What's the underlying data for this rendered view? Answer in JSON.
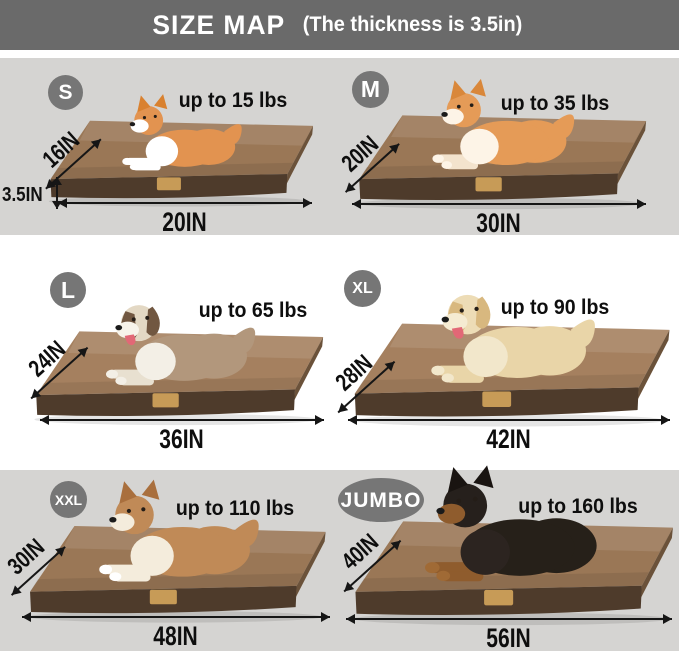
{
  "title": {
    "main": "SIZE MAP",
    "sub": "(The thickness is 3.5in)"
  },
  "panels": [
    {
      "size": "S",
      "weight_limit": "up to 15 lbs",
      "bed_depth": "16IN",
      "bed_width": "20IN",
      "bed_thickness": "3.5IN",
      "dog_breed": "corgi-puppy"
    },
    {
      "size": "M",
      "weight_limit": "up to 35 lbs",
      "bed_depth": "20IN",
      "bed_width": "30IN",
      "dog_breed": "shiba-inu"
    },
    {
      "size": "L",
      "weight_limit": "up to 65 lbs",
      "bed_depth": "24IN",
      "bed_width": "36IN",
      "dog_breed": "australian-shepherd"
    },
    {
      "size": "XL",
      "weight_limit": "up to 90 lbs",
      "bed_depth": "28IN",
      "bed_width": "42IN",
      "dog_breed": "golden-retriever"
    },
    {
      "size": "XXL",
      "weight_limit": "up to 110 lbs",
      "bed_depth": "30IN",
      "bed_width": "48IN",
      "dog_breed": "alaskan-malamute"
    },
    {
      "size": "JUMBO",
      "weight_limit": "up to 160 lbs",
      "bed_depth": "40IN",
      "bed_width": "56IN",
      "dog_breed": "doberman"
    }
  ],
  "colors": {
    "banner_bg": "#6a6a6a",
    "banner_text": "#ffffff",
    "badge_bg": "#767676",
    "row_alt_bg": "#d5d4d2",
    "row_bg": "#ffffff",
    "label_text": "#111111",
    "bed_top": "#9a7756",
    "bed_front": "#4e3b2b",
    "bed_tag": "#c79b57"
  }
}
